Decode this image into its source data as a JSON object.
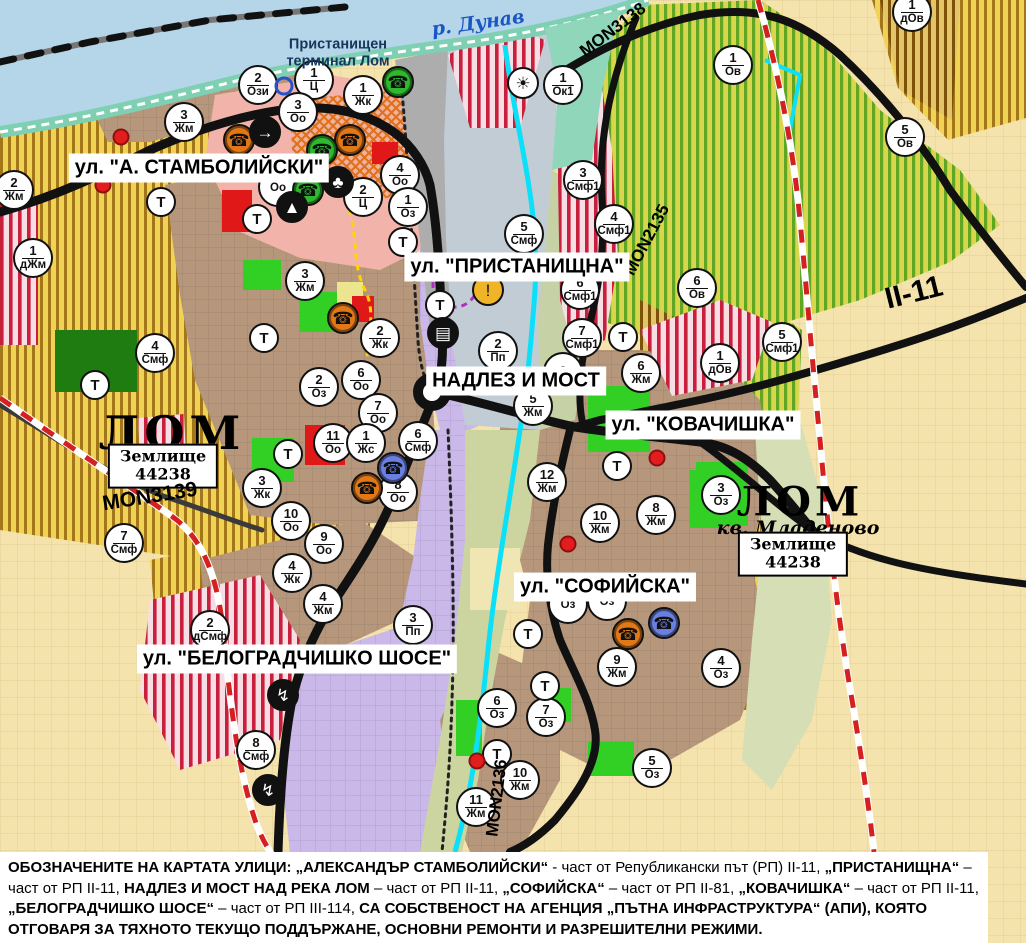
{
  "colors": {
    "water": "#b5d5e9",
    "shore": "#7fd0b2",
    "gold_bg": "#f0d254",
    "gold_stripe": "#a3761a",
    "green_bg": "#d8d64c",
    "green_stripe": "#61a622",
    "residential": "#b6977c",
    "purple": "#cab8e8",
    "pink": "#f2b4aa",
    "red_stripe": "#c81f3c",
    "orange": "#e0701a",
    "park_green": "#32cf25",
    "forest_green": "#1e7c10",
    "cream": "#f4e3ac",
    "olive": "#ccd5a0",
    "port_grey": "#adadad",
    "river_cyan": "#0ce0f8",
    "road_black": "#111111",
    "boundary_red": "#d42020",
    "marker_orange": "#e07818",
    "marker_green": "#2db82d",
    "marker_blue": "#6a7fe0",
    "warning_yellow": "#f0b429"
  },
  "labels": {
    "streets": [
      {
        "text": "ул. \"А. СТАМБОЛИЙСКИ\"",
        "x": 199,
        "y": 168
      },
      {
        "text": "ул. \"ПРИСТАНИЩНА\"",
        "x": 517,
        "y": 267
      },
      {
        "text": "НАДЛЕЗ И МОСТ",
        "x": 516,
        "y": 381
      },
      {
        "text": "ул. \"КОВАЧИШКА\"",
        "x": 703,
        "y": 425
      },
      {
        "text": "ул. \"СОФИЙСКА\"",
        "x": 605,
        "y": 587
      },
      {
        "text": "ул. \"БЕЛОГРАДЧИШКО ШОСЕ\"",
        "x": 297,
        "y": 659
      }
    ],
    "places": [
      {
        "cls": "river",
        "text": "р. Дунав",
        "x": 478,
        "y": 23
      },
      {
        "cls": "terminal",
        "text": "Пристанищен\nтерминал Лом",
        "x": 338,
        "y": 53
      },
      {
        "cls": "city",
        "text": "ЛОМ",
        "x": 172,
        "y": 433
      },
      {
        "cls": "landbox",
        "text": "Землище\n44238",
        "x": 163,
        "y": 466
      },
      {
        "cls": "city2",
        "text": "ЛОМ",
        "x": 800,
        "y": 502
      },
      {
        "cls": "kvartal",
        "text": "кв. Младеново",
        "x": 798,
        "y": 528
      },
      {
        "cls": "landbox",
        "text": "Землище\n44238",
        "x": 793,
        "y": 554
      }
    ],
    "roads": [
      {
        "text": "MON3138",
        "x": 613,
        "y": 30,
        "rot": -37,
        "size": 17
      },
      {
        "text": "MON2135",
        "x": 647,
        "y": 240,
        "rot": -62,
        "size": 17
      },
      {
        "text": "MON3139",
        "x": 150,
        "y": 497,
        "rot": -9,
        "size": 21
      },
      {
        "text": "MON2136",
        "x": 497,
        "y": 798,
        "rot": -83,
        "size": 17
      },
      {
        "text": "II-11",
        "x": 914,
        "y": 293,
        "rot": -14,
        "size": 30
      }
    ]
  },
  "markers": [
    {
      "n": "2",
      "c": "Жм",
      "x": 14,
      "y": 190
    },
    {
      "n": "1",
      "c": "дЖм",
      "x": 33,
      "y": 258
    },
    {
      "n": "2",
      "c": "Ози",
      "x": 258,
      "y": 85
    },
    {
      "n": "1",
      "c": "Ц",
      "x": 314,
      "y": 80
    },
    {
      "n": "1",
      "c": "Жк",
      "x": 363,
      "y": 95
    },
    {
      "n": "3",
      "c": "Оо",
      "x": 298,
      "y": 112
    },
    {
      "n": "3",
      "c": "Жм",
      "x": 184,
      "y": 122
    },
    {
      "n": "4",
      "c": "Оо",
      "x": 400,
      "y": 175
    },
    {
      "n": "2",
      "c": "Ц",
      "x": 363,
      "y": 197
    },
    {
      "n": "1",
      "c": "Оз",
      "x": 408,
      "y": 207
    },
    {
      "n": "",
      "c": "Оо",
      "x": 278,
      "y": 187
    },
    {
      "n": "3",
      "c": "Жм",
      "x": 305,
      "y": 281
    },
    {
      "n": "4",
      "c": "Смф",
      "x": 155,
      "y": 353
    },
    {
      "n": "2",
      "c": "Жк",
      "x": 380,
      "y": 338
    },
    {
      "n": "6",
      "c": "Оо",
      "x": 361,
      "y": 380
    },
    {
      "n": "2",
      "c": "Оз",
      "x": 319,
      "y": 387
    },
    {
      "n": "7",
      "c": "Оо",
      "x": 378,
      "y": 413
    },
    {
      "n": "11",
      "c": "Оо",
      "x": 333,
      "y": 443
    },
    {
      "n": "1",
      "c": "Жс",
      "x": 366,
      "y": 443
    },
    {
      "n": "6",
      "c": "Смф",
      "x": 418,
      "y": 441
    },
    {
      "n": "8",
      "c": "Оо",
      "x": 398,
      "y": 492
    },
    {
      "n": "3",
      "c": "Жк",
      "x": 262,
      "y": 488
    },
    {
      "n": "10",
      "c": "Оо",
      "x": 291,
      "y": 521
    },
    {
      "n": "9",
      "c": "Оо",
      "x": 324,
      "y": 544
    },
    {
      "n": "4",
      "c": "Жк",
      "x": 292,
      "y": 573
    },
    {
      "n": "7",
      "c": "Смф",
      "x": 124,
      "y": 543
    },
    {
      "n": "4",
      "c": "Жм",
      "x": 323,
      "y": 604
    },
    {
      "n": "2",
      "c": "дСмф",
      "x": 210,
      "y": 630
    },
    {
      "n": "3",
      "c": "Пп",
      "x": 413,
      "y": 625
    },
    {
      "n": "8",
      "c": "Смф",
      "x": 256,
      "y": 750
    },
    {
      "n": "5",
      "c": "Смф",
      "x": 524,
      "y": 234
    },
    {
      "n": "1",
      "c": "Ок1",
      "x": 563,
      "y": 85
    },
    {
      "n": "3",
      "c": "Смф1",
      "x": 583,
      "y": 180
    },
    {
      "n": "4",
      "c": "Смф1",
      "x": 614,
      "y": 224
    },
    {
      "n": "6",
      "c": "Смф1",
      "x": 580,
      "y": 290
    },
    {
      "n": "7",
      "c": "Смф1",
      "x": 582,
      "y": 338
    },
    {
      "n": "2",
      "c": "Пп",
      "x": 498,
      "y": 351
    },
    {
      "n": "8",
      "c": "",
      "x": 563,
      "y": 372
    },
    {
      "n": "5",
      "c": "Жм",
      "x": 533,
      "y": 406
    },
    {
      "n": "6",
      "c": "Жм",
      "x": 641,
      "y": 373
    },
    {
      "n": "12",
      "c": "Жм",
      "x": 547,
      "y": 482
    },
    {
      "n": "8",
      "c": "Жм",
      "x": 656,
      "y": 515
    },
    {
      "n": "3",
      "c": "Оз",
      "x": 721,
      "y": 495
    },
    {
      "n": "10",
      "c": "Жм",
      "x": 600,
      "y": 523
    },
    {
      "n": "",
      "c": "Оз",
      "x": 568,
      "y": 604
    },
    {
      "n": "",
      "c": "Оз",
      "x": 607,
      "y": 601
    },
    {
      "n": "9",
      "c": "Жм",
      "x": 617,
      "y": 667
    },
    {
      "n": "4",
      "c": "Оз",
      "x": 721,
      "y": 668
    },
    {
      "n": "6",
      "c": "Оз",
      "x": 497,
      "y": 708
    },
    {
      "n": "7",
      "c": "Оз",
      "x": 546,
      "y": 717
    },
    {
      "n": "10",
      "c": "Жм",
      "x": 520,
      "y": 780
    },
    {
      "n": "11",
      "c": "Жм",
      "x": 476,
      "y": 807
    },
    {
      "n": "5",
      "c": "Оз",
      "x": 652,
      "y": 768
    },
    {
      "n": "6",
      "c": "Ов",
      "x": 697,
      "y": 288
    },
    {
      "n": "1",
      "c": "дОв",
      "x": 720,
      "y": 363
    },
    {
      "n": "5",
      "c": "Смф1",
      "x": 782,
      "y": 342
    },
    {
      "n": "1",
      "c": "Ов",
      "x": 733,
      "y": 65
    },
    {
      "n": "5",
      "c": "Ов",
      "x": 905,
      "y": 137
    },
    {
      "n": "1",
      "c": "дОв",
      "x": 912,
      "y": 12
    },
    {
      "n": "Т",
      "c": "",
      "x": 161,
      "y": 202
    },
    {
      "n": "Т",
      "c": "",
      "x": 257,
      "y": 219
    },
    {
      "n": "Т",
      "c": "",
      "x": 264,
      "y": 338
    },
    {
      "n": "Т",
      "c": "",
      "x": 95,
      "y": 385
    },
    {
      "n": "Т",
      "c": "",
      "x": 288,
      "y": 454
    },
    {
      "n": "Т",
      "c": "",
      "x": 440,
      "y": 305
    },
    {
      "n": "Т",
      "c": "",
      "x": 403,
      "y": 242
    },
    {
      "n": "Т",
      "c": "",
      "x": 623,
      "y": 337
    },
    {
      "n": "Т",
      "c": "",
      "x": 617,
      "y": 466
    },
    {
      "n": "Т",
      "c": "",
      "x": 528,
      "y": 634
    },
    {
      "n": "Т",
      "c": "",
      "x": 545,
      "y": 686
    },
    {
      "n": "Т",
      "c": "",
      "x": 497,
      "y": 754
    }
  ],
  "icons": [
    {
      "name": "monument-icon-orange",
      "glyph": "☎",
      "bg": "#e07818",
      "fg": "#111",
      "ring": true,
      "x": 239,
      "y": 140
    },
    {
      "name": "monument-icon-orange",
      "glyph": "☎",
      "bg": "#e07818",
      "fg": "#111",
      "ring": true,
      "x": 350,
      "y": 140
    },
    {
      "name": "monument-icon-orange",
      "glyph": "☎",
      "bg": "#e07818",
      "fg": "#111",
      "ring": true,
      "x": 343,
      "y": 318
    },
    {
      "name": "monument-icon-orange",
      "glyph": "☎",
      "bg": "#e07818",
      "fg": "#111",
      "ring": true,
      "x": 367,
      "y": 488
    },
    {
      "name": "monument-icon-orange",
      "glyph": "☎",
      "bg": "#e07818",
      "fg": "#111",
      "ring": true,
      "x": 628,
      "y": 634
    },
    {
      "name": "monument-icon-green",
      "glyph": "☎",
      "bg": "#2db82d",
      "fg": "#111",
      "ring": true,
      "x": 398,
      "y": 82
    },
    {
      "name": "monument-icon-green",
      "glyph": "☎",
      "bg": "#2db82d",
      "fg": "#111",
      "ring": true,
      "x": 322,
      "y": 150
    },
    {
      "name": "monument-icon-green",
      "glyph": "☎",
      "bg": "#2db82d",
      "fg": "#111",
      "ring": true,
      "x": 308,
      "y": 190
    },
    {
      "name": "monument-icon-blue",
      "glyph": "☎",
      "bg": "#6a7fe0",
      "fg": "#111",
      "ring": true,
      "x": 393,
      "y": 468
    },
    {
      "name": "monument-icon-blue",
      "glyph": "☎",
      "bg": "#6a7fe0",
      "fg": "#111",
      "ring": true,
      "x": 664,
      "y": 623
    },
    {
      "name": "one-way-arrow-icon",
      "glyph": "→",
      "bg": "#111",
      "fg": "#fff",
      "ring": false,
      "x": 265,
      "y": 132
    },
    {
      "name": "club-icon",
      "glyph": "♣",
      "bg": "#111",
      "fg": "#fff",
      "ring": false,
      "x": 338,
      "y": 182
    },
    {
      "name": "mountain-icon",
      "glyph": "▲",
      "bg": "#111",
      "fg": "#fff",
      "ring": false,
      "x": 292,
      "y": 207
    },
    {
      "name": "fan-icon",
      "glyph": "☀",
      "bg": "#fff",
      "fg": "#111",
      "ring": false,
      "x": 523,
      "y": 83
    },
    {
      "name": "warning-icon",
      "glyph": "!",
      "bg": "#f0b429",
      "fg": "#111",
      "ring": false,
      "x": 488,
      "y": 290
    },
    {
      "name": "truck-icon",
      "glyph": "▤",
      "bg": "#111",
      "fg": "#fff",
      "ring": false,
      "x": 443,
      "y": 333
    },
    {
      "name": "power-icon",
      "glyph": "↯",
      "bg": "#111",
      "fg": "#fff",
      "ring": false,
      "x": 283,
      "y": 695
    },
    {
      "name": "power-icon",
      "glyph": "↯",
      "bg": "#111",
      "fg": "#fff",
      "ring": false,
      "x": 268,
      "y": 790
    }
  ],
  "dots": [
    {
      "type": "red",
      "x": 121,
      "y": 137
    },
    {
      "type": "red",
      "x": 103,
      "y": 185
    },
    {
      "type": "red",
      "x": 568,
      "y": 544
    },
    {
      "type": "red",
      "x": 657,
      "y": 458
    },
    {
      "type": "red",
      "x": 477,
      "y": 761
    },
    {
      "type": "bluering",
      "x": 284,
      "y": 86
    }
  ],
  "footer": {
    "segments": [
      {
        "t": "ОБОЗНАЧЕНИТЕ НА КАРТАТА УЛИЦИ: „АЛЕКСАНДЪР СТАМБОЛИЙСКИ“",
        "b": true
      },
      {
        "t": " - част от Републикански път (РП) II-11, ",
        "b": false
      },
      {
        "t": "„ПРИСТАНИЩНА“",
        "b": true
      },
      {
        "t": " – част от РП II-11, ",
        "b": false
      },
      {
        "t": "НАДЛЕЗ И МОСТ НАД РЕКА ЛОМ",
        "b": true
      },
      {
        "t": " – част от РП II-11, ",
        "b": false
      },
      {
        "t": "„СОФИЙСКА“",
        "b": true
      },
      {
        "t": " – част от РП II-81, ",
        "b": false
      },
      {
        "t": "„КОВАЧИШКА“",
        "b": true
      },
      {
        "t": " – част от РП II-11, ",
        "b": false
      },
      {
        "t": "„БЕЛОГРАДЧИШКО ШОСЕ“",
        "b": true
      },
      {
        "t": " – част от РП III-114, ",
        "b": false
      },
      {
        "t": "СА СОБСТВЕНОСТ НА АГЕНЦИЯ „ПЪТНА ИНФРАСТРУКТУРА“ (АПИ), КОЯТО ОТГОВАРЯ ЗА ТЯХНОТО ТЕКУЩО ПОДДЪРЖАНЕ, ОСНОВНИ РЕМОНТИ И РАЗРЕШИТЕЛНИ РЕЖИМИ.",
        "b": true
      }
    ]
  }
}
